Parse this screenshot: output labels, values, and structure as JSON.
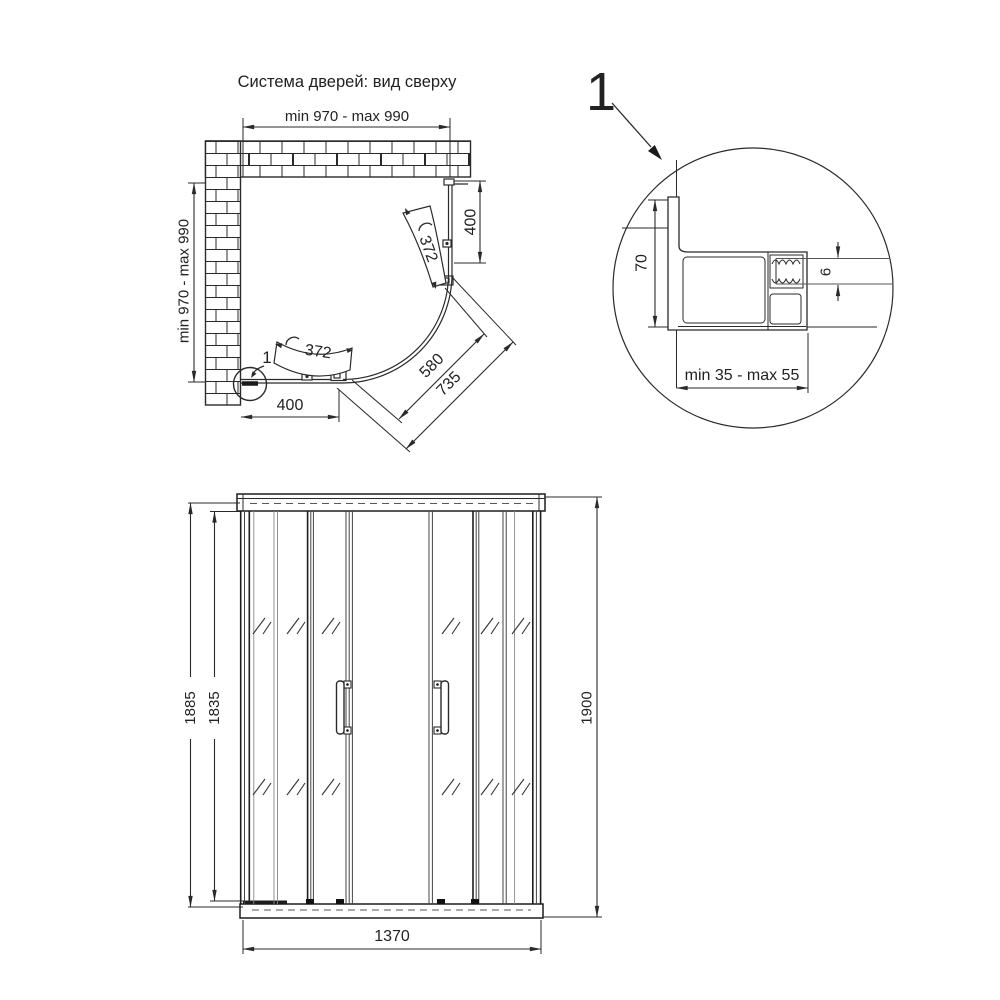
{
  "title": "Система дверей: вид сверху",
  "top_view": {
    "dim_opening_width": "min 970 - max 990",
    "dim_opening_depth": "min 970 - max 990",
    "dim_side_panel_right": "400",
    "dim_side_panel_left": "400",
    "arc_len_door_upper": "372",
    "arc_len_door_lower": "372",
    "dim_diag_inner": "580",
    "dim_diag_outer": "735",
    "detail_callout": "1"
  },
  "detail_view": {
    "callout": "1",
    "dim_profile_depth": "70",
    "dim_glass_thickness": "6",
    "dim_adjust_range": "min 35 - max 55"
  },
  "front_view": {
    "dim_height_outer": "1885",
    "dim_height_inner": "1835",
    "dim_height_total": "1900",
    "dim_width_total": "1370"
  },
  "colors": {
    "line": "#2a2a2a",
    "glass_line": "#666666",
    "background": "#ffffff"
  }
}
